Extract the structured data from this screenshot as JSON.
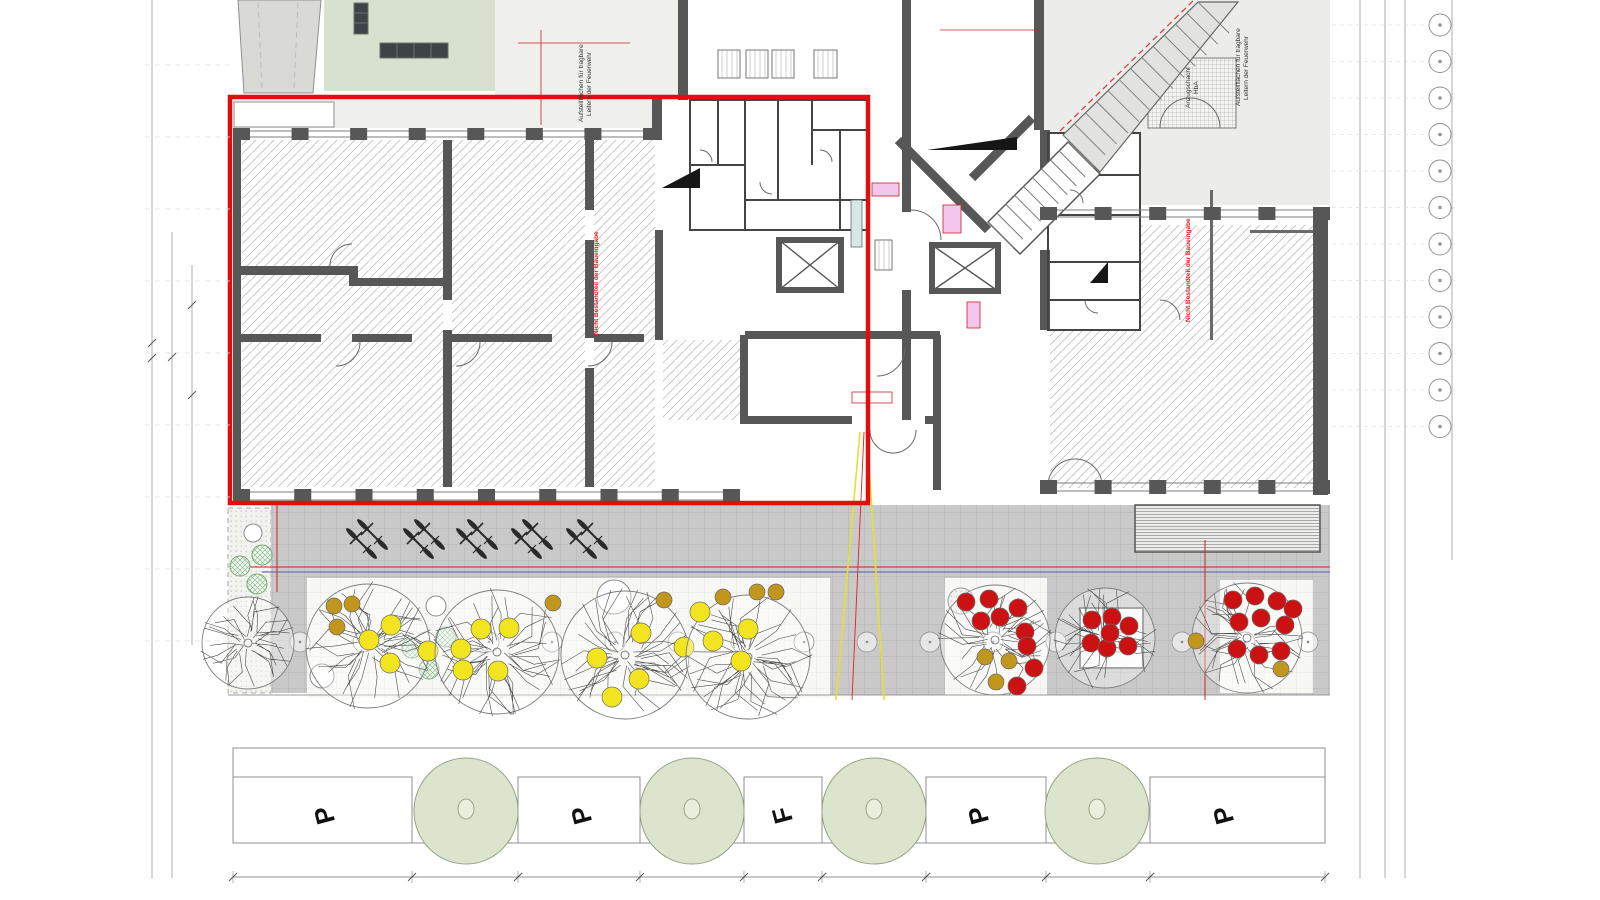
{
  "labels": {
    "fire_ladder_line1": "Aufstellflächen für tragbare",
    "fire_ladder_line2": "Leitern der Feuerwehr",
    "shaft_line1": "Anzugschacht",
    "shaft_line2": "HbA",
    "not_part": "Nicht Bestandteil der Baueingabe"
  },
  "parking": {
    "stalls": [
      {
        "label": "P",
        "x": 333
      },
      {
        "label": "P",
        "x": 590
      },
      {
        "label": "F",
        "x": 791
      },
      {
        "label": "P",
        "x": 987
      },
      {
        "label": "P",
        "x": 1232
      }
    ],
    "lawn_trees_x": [
      466,
      692,
      874,
      1097
    ]
  },
  "site": {
    "bike_group_count": 5,
    "bollard_count": 17,
    "trees": [
      {
        "cx": 248,
        "cy": 643,
        "r": 46,
        "dots": []
      },
      {
        "cx": 368,
        "cy": 646,
        "r": 62,
        "dots": [
          {
            "x": 334,
            "y": 606,
            "c": "olive"
          },
          {
            "x": 352,
            "y": 604,
            "c": "olive"
          },
          {
            "x": 337,
            "y": 627,
            "c": "olive"
          },
          {
            "x": 391,
            "y": 625,
            "c": "yellow"
          },
          {
            "x": 369,
            "y": 640,
            "c": "yellow"
          },
          {
            "x": 390,
            "y": 663,
            "c": "yellow"
          },
          {
            "x": 428,
            "y": 651,
            "c": "yellow"
          }
        ]
      },
      {
        "cx": 497,
        "cy": 652,
        "r": 62,
        "dots": [
          {
            "x": 481,
            "y": 629,
            "c": "yellow"
          },
          {
            "x": 509,
            "y": 628,
            "c": "yellow"
          },
          {
            "x": 461,
            "y": 649,
            "c": "yellow"
          },
          {
            "x": 463,
            "y": 670,
            "c": "yellow"
          },
          {
            "x": 498,
            "y": 671,
            "c": "yellow"
          },
          {
            "x": 553,
            "y": 603,
            "c": "olive"
          }
        ]
      },
      {
        "cx": 625,
        "cy": 655,
        "r": 64,
        "dots": [
          {
            "x": 597,
            "y": 658,
            "c": "yellow"
          },
          {
            "x": 641,
            "y": 633,
            "c": "yellow"
          },
          {
            "x": 639,
            "y": 679,
            "c": "yellow"
          },
          {
            "x": 684,
            "y": 647,
            "c": "yellow"
          },
          {
            "x": 612,
            "y": 697,
            "c": "yellow"
          },
          {
            "x": 664,
            "y": 600,
            "c": "olive"
          }
        ]
      },
      {
        "cx": 748,
        "cy": 657,
        "r": 62,
        "dots": [
          {
            "x": 713,
            "y": 641,
            "c": "yellow"
          },
          {
            "x": 748,
            "y": 629,
            "c": "yellow"
          },
          {
            "x": 700,
            "y": 612,
            "c": "yellow"
          },
          {
            "x": 741,
            "y": 661,
            "c": "yellow"
          },
          {
            "x": 757,
            "y": 592,
            "c": "olive"
          },
          {
            "x": 776,
            "y": 592,
            "c": "olive"
          },
          {
            "x": 723,
            "y": 597,
            "c": "olive"
          }
        ]
      },
      {
        "cx": 995,
        "cy": 640,
        "r": 55,
        "dots": [
          {
            "x": 966,
            "y": 602,
            "c": "red"
          },
          {
            "x": 989,
            "y": 599,
            "c": "red"
          },
          {
            "x": 981,
            "y": 621,
            "c": "red"
          },
          {
            "x": 1000,
            "y": 617,
            "c": "red"
          },
          {
            "x": 1018,
            "y": 608,
            "c": "red"
          },
          {
            "x": 1025,
            "y": 632,
            "c": "red"
          },
          {
            "x": 1027,
            "y": 646,
            "c": "red"
          },
          {
            "x": 1034,
            "y": 668,
            "c": "red"
          },
          {
            "x": 1017,
            "y": 686,
            "c": "red"
          },
          {
            "x": 985,
            "y": 657,
            "c": "olive"
          },
          {
            "x": 1009,
            "y": 661,
            "c": "olive"
          },
          {
            "x": 996,
            "y": 682,
            "c": "olive"
          }
        ]
      },
      {
        "cx": 1105,
        "cy": 638,
        "r": 50,
        "dots": [
          {
            "x": 1092,
            "y": 620,
            "c": "red"
          },
          {
            "x": 1112,
            "y": 617,
            "c": "red"
          },
          {
            "x": 1129,
            "y": 626,
            "c": "red"
          },
          {
            "x": 1091,
            "y": 643,
            "c": "red"
          },
          {
            "x": 1107,
            "y": 648,
            "c": "red"
          },
          {
            "x": 1128,
            "y": 646,
            "c": "red"
          },
          {
            "x": 1110,
            "y": 633,
            "c": "red"
          }
        ]
      },
      {
        "cx": 1247,
        "cy": 638,
        "r": 55,
        "dots": [
          {
            "x": 1233,
            "y": 600,
            "c": "red"
          },
          {
            "x": 1255,
            "y": 596,
            "c": "red"
          },
          {
            "x": 1277,
            "y": 601,
            "c": "red"
          },
          {
            "x": 1293,
            "y": 609,
            "c": "red"
          },
          {
            "x": 1239,
            "y": 622,
            "c": "red"
          },
          {
            "x": 1261,
            "y": 618,
            "c": "red"
          },
          {
            "x": 1285,
            "y": 625,
            "c": "red"
          },
          {
            "x": 1237,
            "y": 649,
            "c": "red"
          },
          {
            "x": 1259,
            "y": 655,
            "c": "red"
          },
          {
            "x": 1281,
            "y": 651,
            "c": "red"
          },
          {
            "x": 1196,
            "y": 641,
            "c": "olive"
          },
          {
            "x": 1281,
            "y": 669,
            "c": "olive"
          }
        ]
      }
    ]
  },
  "annotations": {
    "grid_bubble_count": 12
  },
  "colors": {
    "red_outline": "#e10e0e",
    "dot_yellow": "#f2e41e",
    "dot_olive": "#c0961d",
    "dot_red": "#cc1112",
    "lawn_green": "#dce4cd",
    "roof_green": "#d8e1cd",
    "paving_gray": "#c9c9c9",
    "wall_gray": "#575757",
    "annotation_red": "#cc2222",
    "annotation_yellow": "#e6e030",
    "annotation_blue": "#7070b8"
  }
}
